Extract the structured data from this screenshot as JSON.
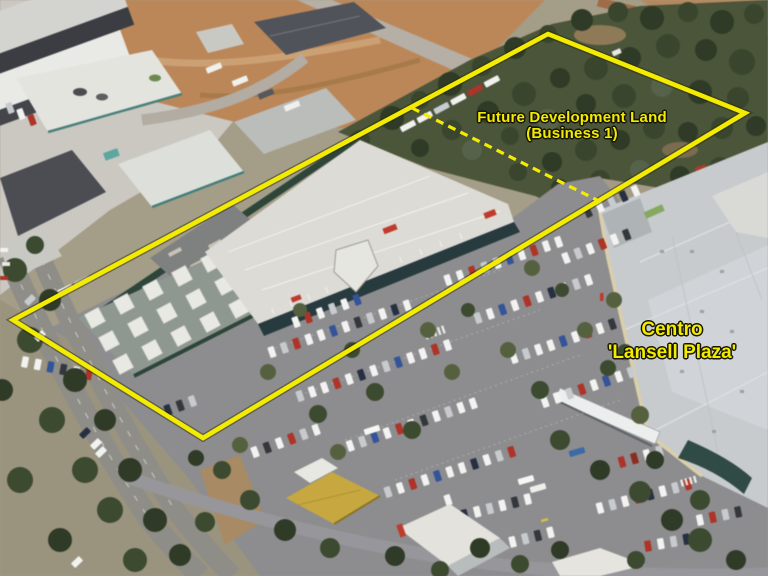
{
  "photo": {
    "type": "aerial-photograph",
    "annotation_color": "#f3eb00"
  },
  "annotations": {
    "boundary": {
      "color": "#f3eb00",
      "line_style": "solid",
      "points": "548,34 745,113 203,438 13,320"
    },
    "divider": {
      "color": "#f3eb00",
      "line_style": "dashed",
      "points": "412,108 597,200"
    },
    "future_dev": {
      "line1": "Future Development Land",
      "line2": "(Business 1)"
    },
    "centro": {
      "line1": "Centro",
      "line2": "'Lansell Plaza'"
    }
  }
}
